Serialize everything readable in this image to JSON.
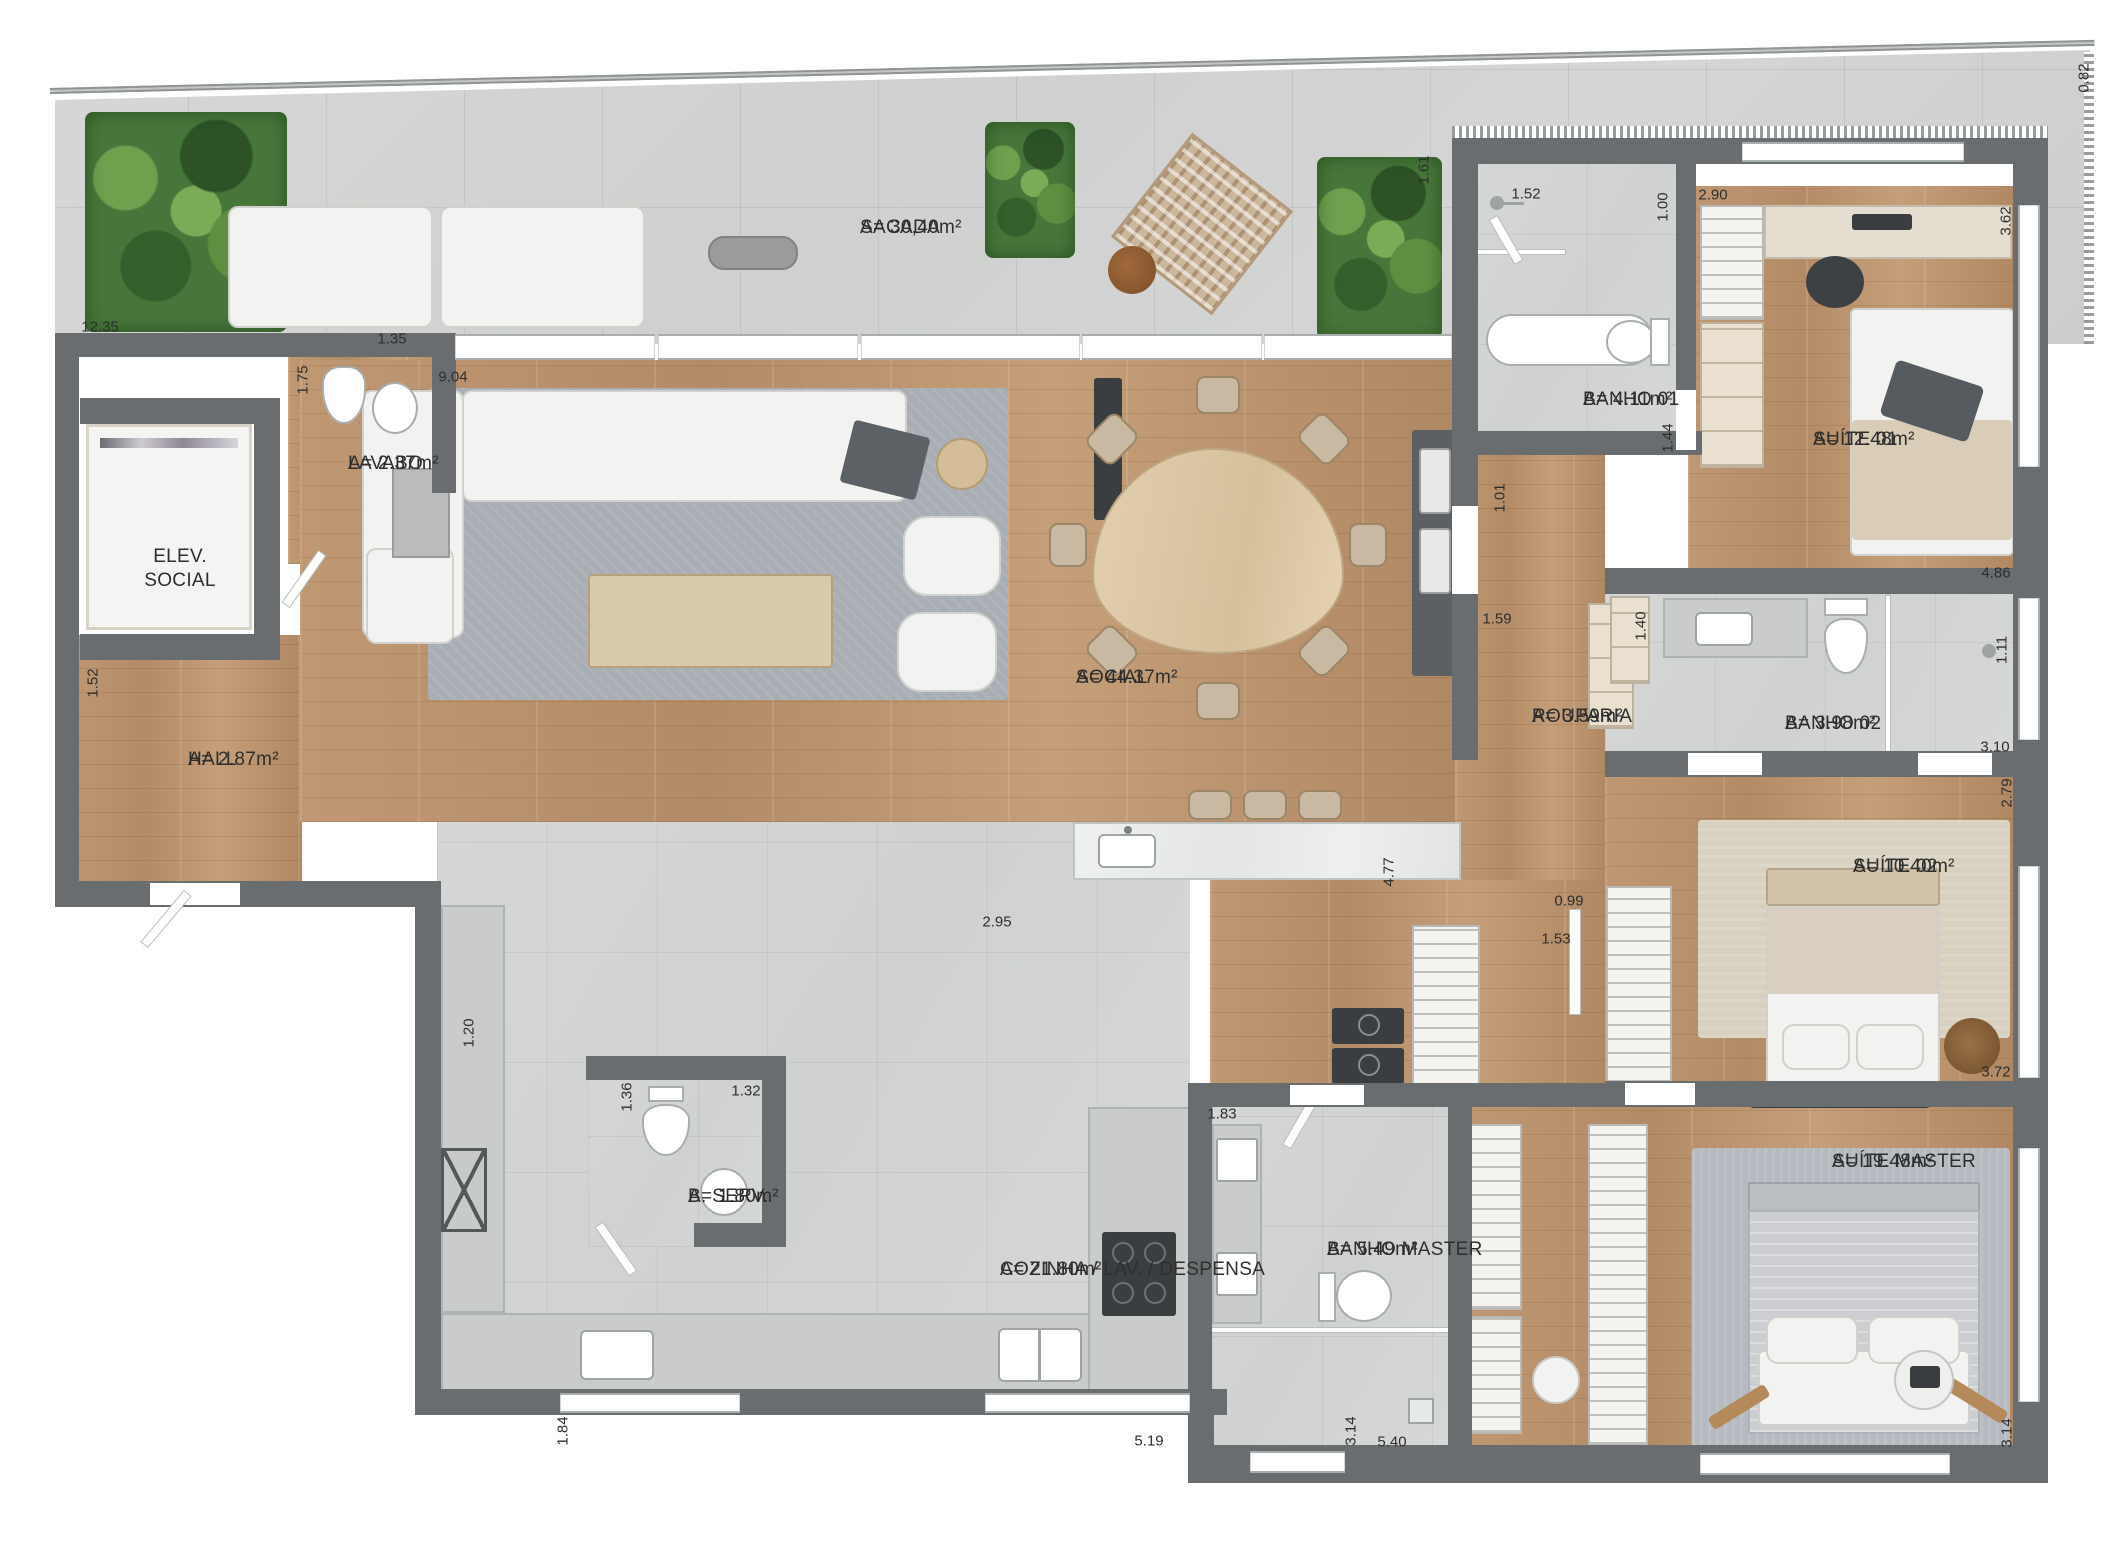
{
  "plan_title": "Apartment floor plan",
  "colors": {
    "wall": "#6a6d6f",
    "wood_floor": "#bb946f",
    "tile_floor": "#d3d6d5",
    "balcony_concrete": "#d2d3d2",
    "plant_green": "#47763a",
    "label_text": "#2e2e2e"
  },
  "rooms": [
    {
      "name": "SACADA",
      "area": "A= 30,40m²"
    },
    {
      "name": "LAVABO",
      "area": "A= 2.37m²"
    },
    {
      "name": "ELEV. SOCIAL",
      "area": ""
    },
    {
      "name": "HALL",
      "area": "A= 2.87m²"
    },
    {
      "name": "SOCIAL",
      "area": "A= 44.37m²"
    },
    {
      "name": "BANHO 01",
      "area": "A= 4.11m²"
    },
    {
      "name": "SUÍTE 01",
      "area": "A= 12.48m²"
    },
    {
      "name": "ROUPARIA",
      "area": "A= 3.59m²"
    },
    {
      "name": "BANHO 02",
      "area": "A= 3.98m²"
    },
    {
      "name": "SUÍTE 02",
      "area": "A= 10.40m²"
    },
    {
      "name": "SUÍTE MASTER",
      "area": "A= 19.48m²"
    },
    {
      "name": "BANHO MASTER",
      "area": "A= 5.49m²"
    },
    {
      "name": "B. SERV.",
      "area": "A= 1.80m²"
    },
    {
      "name": "COZINHA / LAV. / DESPENSA",
      "area": "A= 21.80m²"
    }
  ],
  "dims": [
    {
      "v": "12.35"
    },
    {
      "v": "0.82"
    },
    {
      "v": "1.61"
    },
    {
      "v": "1.52"
    },
    {
      "v": "2.90"
    },
    {
      "v": "1.00"
    },
    {
      "v": "3.62"
    },
    {
      "v": "1.44"
    },
    {
      "v": "4.86"
    },
    {
      "v": "1.75"
    },
    {
      "v": "1.35"
    },
    {
      "v": "9.04"
    },
    {
      "v": "1.52"
    },
    {
      "v": "1.40"
    },
    {
      "v": "1.11"
    },
    {
      "v": "1.01"
    },
    {
      "v": "1.59"
    },
    {
      "v": "3.10"
    },
    {
      "v": "2.79"
    },
    {
      "v": "4.77"
    },
    {
      "v": "0.99"
    },
    {
      "v": "1.53"
    },
    {
      "v": "2.95"
    },
    {
      "v": "3.72"
    },
    {
      "v": "1.20"
    },
    {
      "v": "1.36"
    },
    {
      "v": "1.32"
    },
    {
      "v": "1.83"
    },
    {
      "v": "1.84"
    },
    {
      "v": "5.19"
    },
    {
      "v": "3.14"
    },
    {
      "v": "5.40"
    },
    {
      "v": "3.14"
    }
  ]
}
